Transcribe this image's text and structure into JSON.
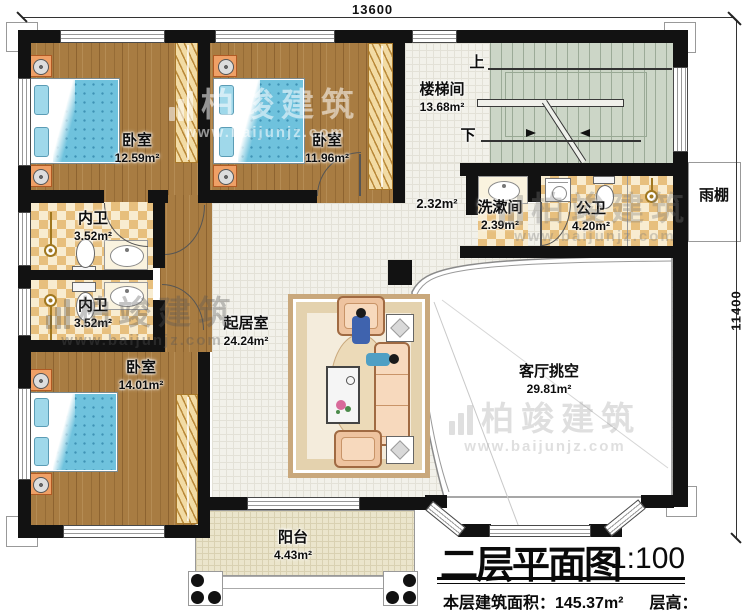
{
  "watermark": {
    "brand": "柏竣建筑",
    "url": "www.baijunjz.com"
  },
  "dimensions": {
    "width": "13600",
    "height": "11400"
  },
  "stairs": {
    "up": "上",
    "down": "下"
  },
  "rooms": {
    "bedroom1": {
      "name": "卧室",
      "area": "12.59m²"
    },
    "bedroom2": {
      "name": "卧室",
      "area": "11.96m²"
    },
    "stairwell": {
      "name": "楼梯间",
      "area": "13.68m²"
    },
    "hall": {
      "area": "2.32m²"
    },
    "washroom": {
      "name": "洗漱间",
      "area": "2.39m²"
    },
    "publicBath": {
      "name": "公卫",
      "area": "4.20m²"
    },
    "bath1": {
      "name": "内卫",
      "area": "3.52m²"
    },
    "bath2": {
      "name": "内卫",
      "area": "3.52m²"
    },
    "living": {
      "name": "起居室",
      "area": "24.24m²"
    },
    "bedroom3": {
      "name": "卧室",
      "area": "14.01m²"
    },
    "void": {
      "name": "客厅挑空",
      "area": "29.81m²"
    },
    "balcony": {
      "name": "阳台",
      "area": "4.43m²"
    },
    "canopy": {
      "name": "雨棚"
    }
  },
  "title_block": {
    "title": "二层平面图",
    "scale": "1:100",
    "area_info": "本层建筑面积：145.37m²",
    "height_info": "层高：3.3m"
  }
}
